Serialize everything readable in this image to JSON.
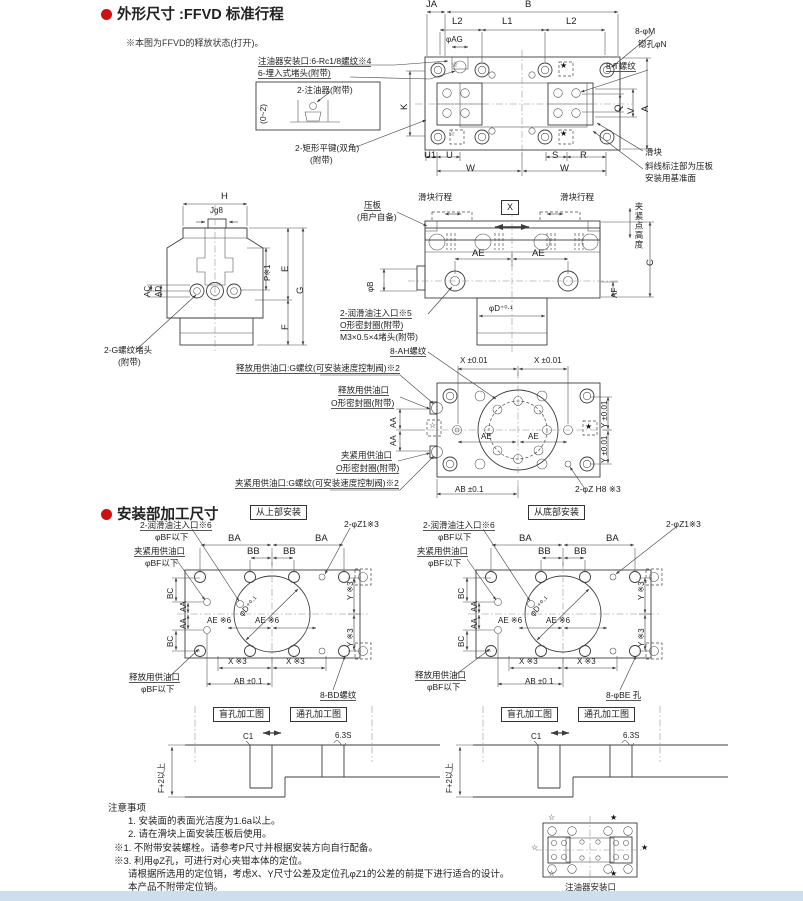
{
  "colors": {
    "accent": "#cc1111",
    "line": "#3c3c3c",
    "footer_band": "#cfdeee"
  },
  "sections": {
    "outline": {
      "title": "外形尺寸 :FFVD 标准行程",
      "note": "※本图为FFVD的释放状态(打开)。"
    },
    "mounting": {
      "title": "安装部加工尺寸"
    },
    "notes": {
      "title": "注意事项",
      "items": [
        "1. 安装面的表面光洁度为1.6a以上。",
        "2. 请在滑块上面安装压板后使用。",
        "※1. 不附带安装螺栓。请参考P尺寸并根据安装方向自行配备。",
        "※3. 利用φZ孔，可进行对心夹钳本体的定位。",
        "请根据所选用的定位销，考虑X、Y尺寸公差及定位孔φZ1的公差的前提下进行适合的设计。",
        "本产品不附带定位销。"
      ]
    }
  },
  "glyphs": {
    "star_filled": "★",
    "star_open": "☆"
  },
  "labels": {
    "topview_port_callout": "注油器安装口:6-Rc1/8螺纹※4",
    "topview_plug_callout": "6-埋入式堵头(附带)",
    "detail_injector": "2-注油器(附带)",
    "detail_range": "(0~2)",
    "key_callout_1": "2-矩形平键(双角)",
    "key_callout_2": "(附带)",
    "dim_ja": "JA",
    "dim_b": "B",
    "dim_l2": "L2",
    "dim_l1": "L1",
    "dim_ag": "φAG",
    "callout_8m": "8-φM",
    "callout_counterbore": "锪孔φN",
    "callout_8t": "8-T螺纹",
    "dim_k": "K",
    "dim_q": "Q",
    "dim_v": "V",
    "dim_a": "A",
    "dim_u1": "U1",
    "dim_u": "U",
    "dim_w": "W",
    "dim_s": "S",
    "dim_r": "R",
    "callout_slider": "滑块",
    "callout_datum_1": "斜线标注部为压板",
    "callout_datum_2": "安装用基准面",
    "dim_h": "H",
    "dim_j": "Jg8",
    "dim_ac": "AC",
    "dim_ad": "AD",
    "dim_p": "P※1",
    "dim_e": "E",
    "dim_g": "G",
    "dim_f": "F",
    "callout_gplug_1": "2-G螺纹堵头",
    "callout_gplug_2": "(附带)",
    "callout_presser_1": "压板",
    "callout_presser_2": "(用户自备)",
    "stroke_label": "滑块行程",
    "xbox": "X",
    "clamp_height": "夹紧点高度",
    "dim_ae": "AE",
    "dim_c": "C",
    "dim_af": "AF",
    "dim_phib": "φB",
    "dim_phid": "φD⁺⁰·¹",
    "lube_callout_1": "2-润滑油注入口※5",
    "lube_callout_2": "O形密封圈(附带)",
    "lube_callout_3": "M3×0.5×4堵头(附带)",
    "callout_8ah": "8-AH螺纹",
    "release_g_callout": "释放用供油口:G螺纹(可安装速度控制阀)※2",
    "release_callout_1": "释放用供油口",
    "release_callout_2": "O形密封圈(附带)",
    "dim_aa": "AA",
    "clamp_callout_1": "夹紧用供油口",
    "clamp_callout_2": "O形密封圈(附带)",
    "clamp_g_callout": "夹紧用供油口:G螺纹(可安装速度控制阀)※2",
    "dim_x001": "X ±0.01",
    "dim_y001": "Y ±0.01",
    "dim_ab01": "AB ±0.1",
    "callout_2phiz": "2-φZ H8 ※3",
    "box_top_mount": "从上部安装",
    "box_bottom_mount": "从底部安装",
    "mnt_lube": "2-润滑油注入口※6",
    "mnt_bf": "φBF以下",
    "mnt_clamp": "夹紧用供油口",
    "mnt_release": "释放用供油口",
    "dim_ba": "BA",
    "dim_bb": "BB",
    "mnt_z1": "2-φZ1※3",
    "dim_bc": "BC",
    "mnt_ae6": "AE ※6",
    "mnt_phid": "φD⁺⁰·¹",
    "dim_y3": "Y ※3",
    "dim_x3": "X ※3",
    "callout_8bd": "8-BD螺纹",
    "callout_8be": "8-φBE 孔",
    "box_blind": "盲孔加工图",
    "box_through": "通孔加工图",
    "dim_c1": "C1",
    "finish_63": "6.3S",
    "dim_f2": "F+2以上",
    "injector_port_label": "注油器安装口"
  }
}
